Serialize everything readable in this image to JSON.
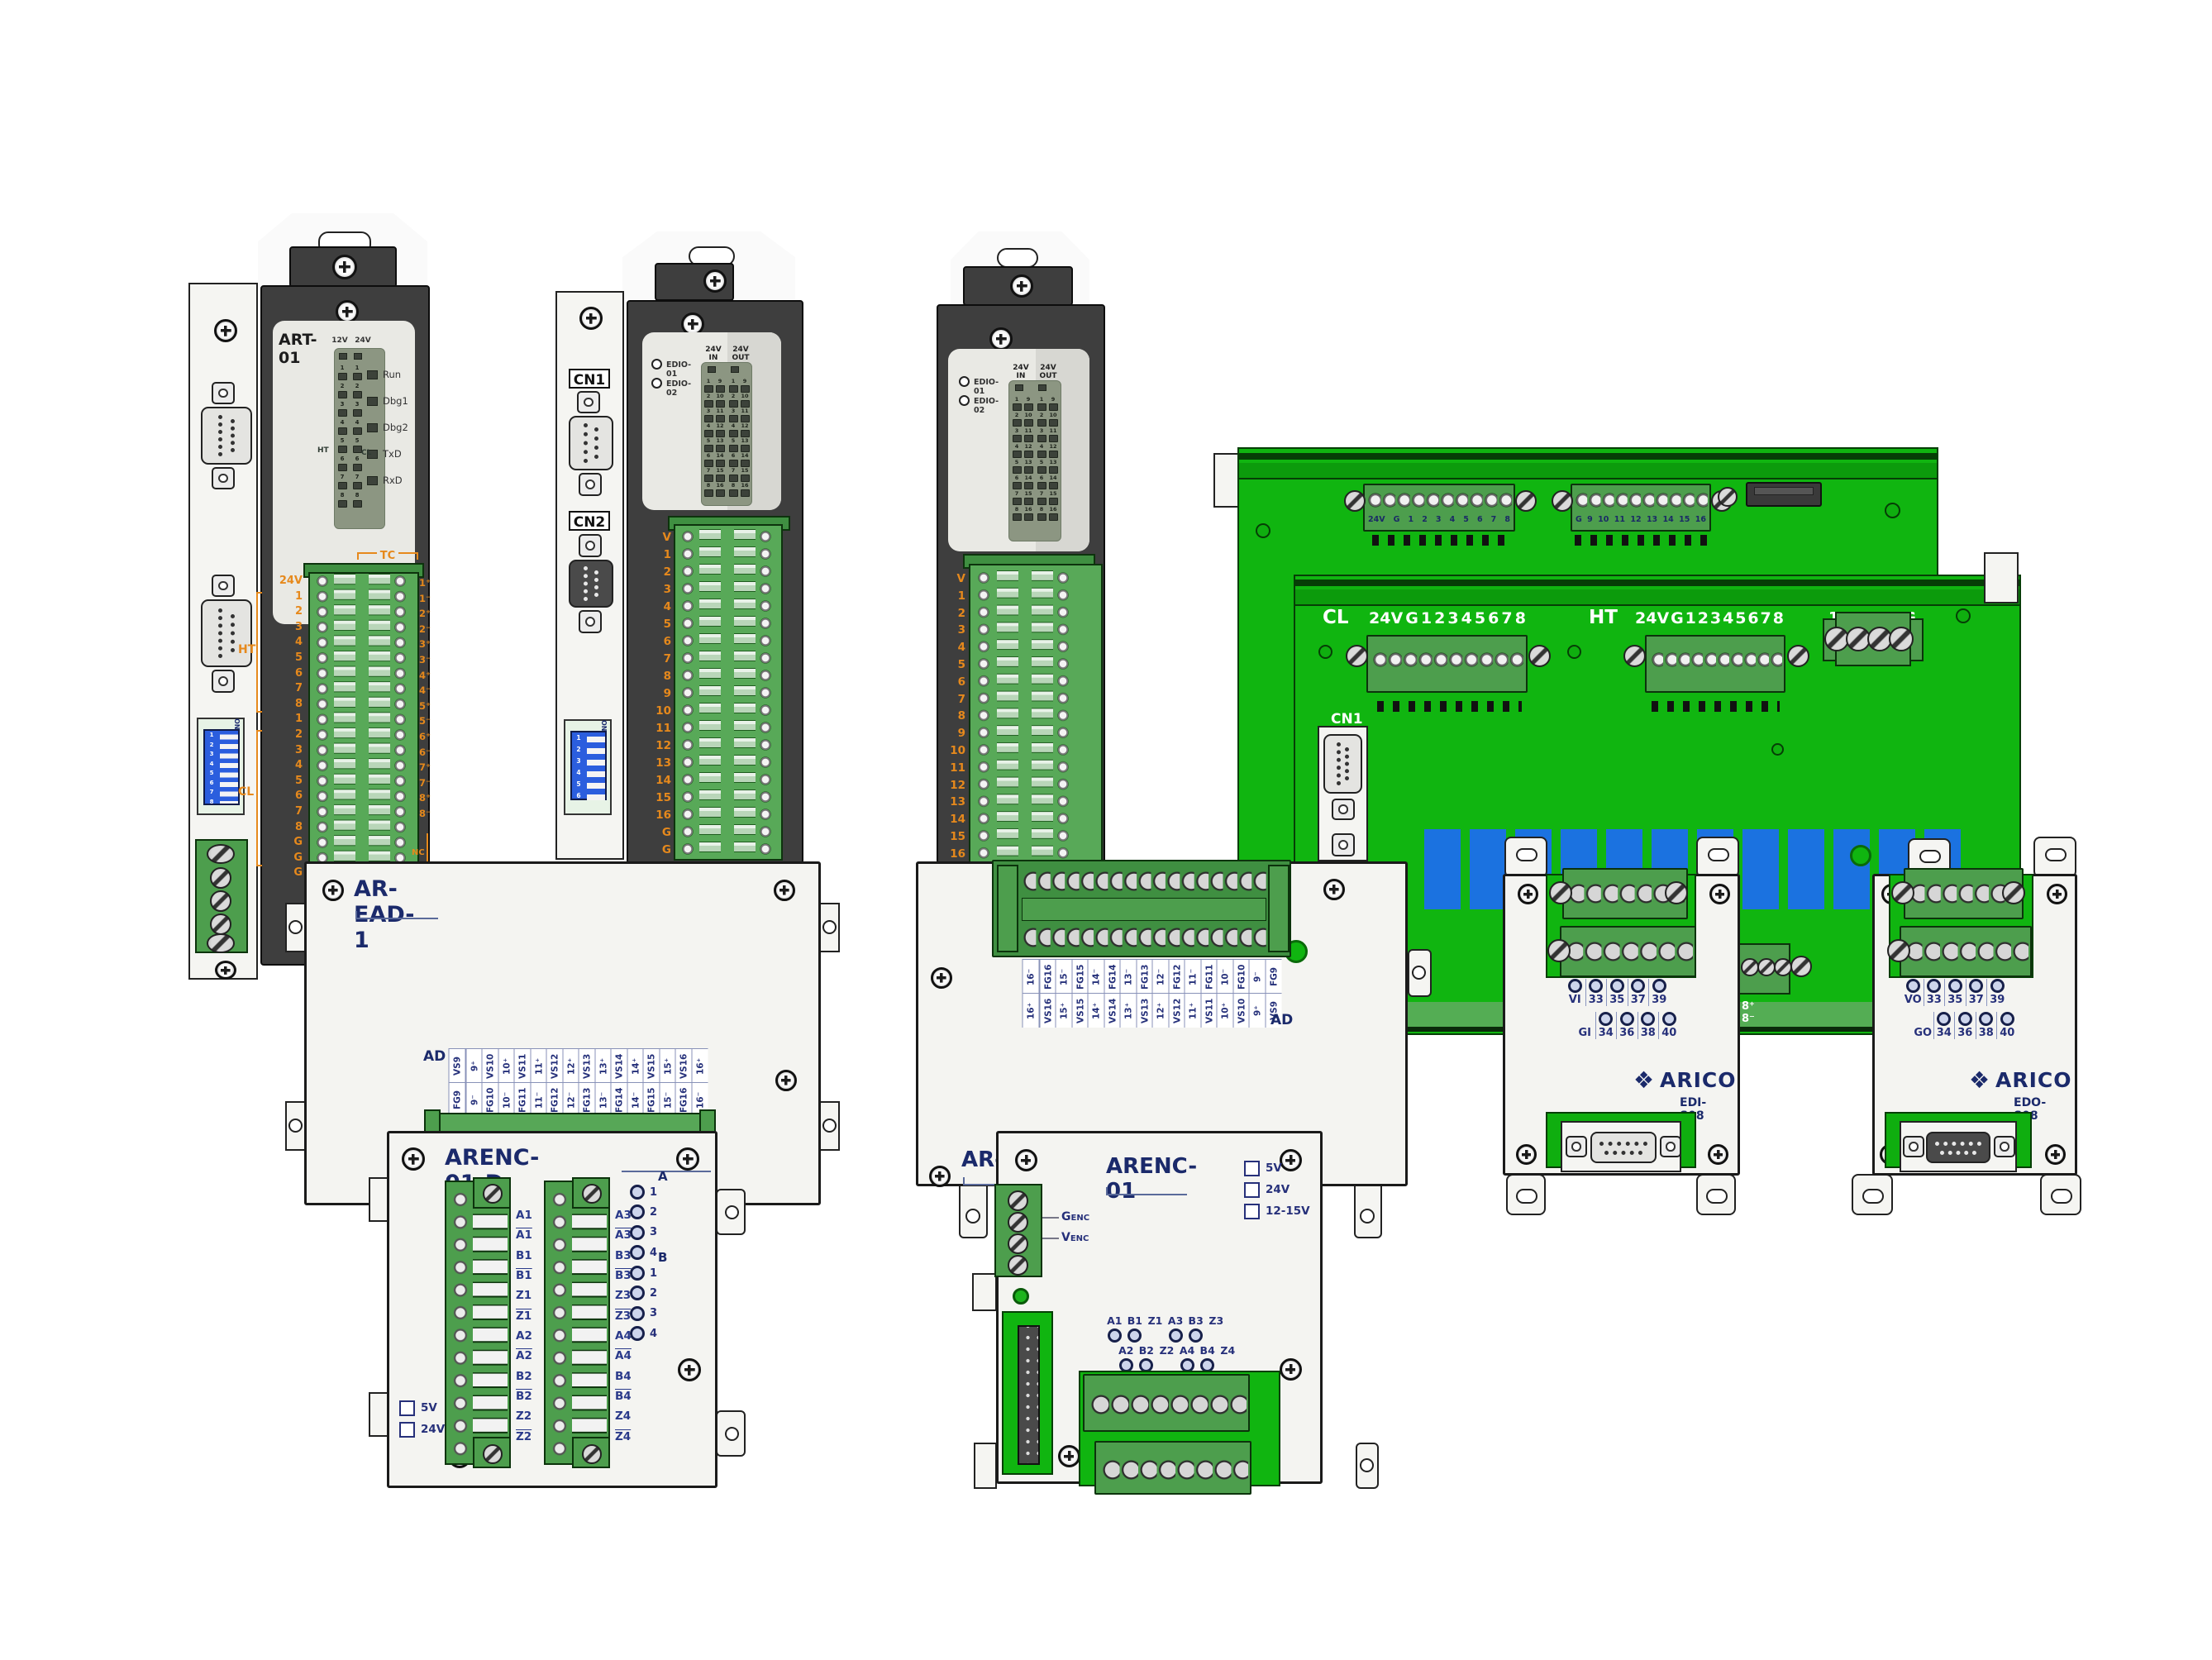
{
  "art01": {
    "title": "ART-01",
    "v12": "12V",
    "v24": "24V",
    "status": [
      "Run",
      "Dbg1",
      "Dbg2",
      "TxD",
      "RxD"
    ],
    "mnums": [
      "1",
      "2",
      "3",
      "4",
      "5",
      "6",
      "7",
      "8"
    ],
    "ht": "HT",
    "cl": "CL",
    "tc": "TC",
    "strip_left": [
      "24V",
      "1",
      "2",
      "3",
      "4",
      "5",
      "6",
      "7",
      "8",
      "1",
      "2",
      "3",
      "4",
      "5",
      "6",
      "7",
      "8",
      "G",
      "G",
      "G"
    ],
    "right": [
      "1⁺",
      "1⁻",
      "2⁺",
      "2⁻",
      "3⁺",
      "3⁻",
      "4⁺",
      "4⁻",
      "5⁺",
      "5⁻",
      "6⁺",
      "6⁻",
      "7⁺",
      "7⁻",
      "8⁺",
      "8⁻"
    ],
    "nc": "NC",
    "dip_on": "ON",
    "dip": [
      "1",
      "2",
      "3",
      "4",
      "5",
      "6",
      "7",
      "8"
    ]
  },
  "edio": {
    "cn1": "CN1",
    "cn2": "CN2",
    "led1": "EDIO-01",
    "led2": "EDIO-02",
    "v24": "24V",
    "in": "IN",
    "out": "OUT",
    "ga": [
      "1",
      "2",
      "3",
      "4",
      "5",
      "6",
      "7",
      "8"
    ],
    "gb": [
      "9",
      "10",
      "11",
      "12",
      "13",
      "14",
      "15",
      "16"
    ],
    "strip2": [
      "V",
      "1",
      "2",
      "3",
      "4",
      "5",
      "6",
      "7",
      "8",
      "9",
      "10",
      "11",
      "12",
      "13",
      "14",
      "15",
      "16",
      "G",
      "G"
    ],
    "strip3": [
      "V",
      "1",
      "2",
      "3",
      "4",
      "5",
      "6",
      "7",
      "8",
      "9",
      "10",
      "11",
      "12",
      "13",
      "14",
      "15",
      "16"
    ],
    "dip_on": "ON",
    "dip": [
      "1",
      "2",
      "3",
      "4",
      "5",
      "6"
    ]
  },
  "board": {
    "tb1": [
      "24V",
      "G",
      "1",
      "2",
      "3",
      "4",
      "5",
      "6",
      "7",
      "8"
    ],
    "tb2": [
      "G",
      "9",
      "10",
      "11",
      "12",
      "13",
      "14",
      "15",
      "16"
    ],
    "cl": "CL",
    "ht": "HT",
    "io": [
      "24V",
      "G",
      "1",
      "2",
      "3",
      "4",
      "5",
      "6",
      "7",
      "8"
    ],
    "pwr": [
      "12V",
      "12G",
      "FG"
    ],
    "cn1": "CN1",
    "edge": "8⁺ 8⁻"
  },
  "aread1": {
    "title": "AR-EAD-1",
    "ad": "AD",
    "top": [
      "VS9",
      "9⁺",
      "VS10",
      "10⁺",
      "VS11",
      "11⁺",
      "VS12",
      "12⁺",
      "VS13",
      "13⁺",
      "VS14",
      "14⁺",
      "VS15",
      "15⁺",
      "VS16",
      "16⁺"
    ],
    "bot": [
      "FG9",
      "9⁻",
      "FG10",
      "10⁻",
      "FG11",
      "11⁻",
      "FG12",
      "12⁻",
      "FG13",
      "13⁻",
      "FG14",
      "14⁻",
      "FG15",
      "15⁻",
      "FG16",
      "16⁻"
    ]
  },
  "armid": {
    "title": "AR-",
    "ad": "AD",
    "top": [
      "16⁻",
      "FG16",
      "15⁻",
      "FG15",
      "14⁻",
      "FG14",
      "13⁻",
      "FG13",
      "12⁻",
      "FG12",
      "11⁻",
      "FG11",
      "10⁻",
      "FG10",
      "9⁻",
      "FG9"
    ],
    "bot": [
      "16⁺",
      "VS16",
      "15⁺",
      "VS15",
      "14⁺",
      "VS14",
      "13⁺",
      "VS13",
      "12⁺",
      "VS12",
      "11⁺",
      "VS11",
      "10⁺",
      "VS10",
      "9⁺",
      "VS9"
    ]
  },
  "arenc01d": {
    "title": "ARENC-01-D",
    "t1": [
      {
        "t": "A1"
      },
      {
        "t": "A1",
        "bar": true
      },
      {
        "t": "B1"
      },
      {
        "t": "B1",
        "bar": true
      },
      {
        "t": "Z1"
      },
      {
        "t": "Z1",
        "bar": true
      },
      {
        "t": "A2"
      },
      {
        "t": "A2",
        "bar": true
      },
      {
        "t": "B2"
      },
      {
        "t": "B2",
        "bar": true
      },
      {
        "t": "Z2"
      },
      {
        "t": "Z2",
        "bar": true
      }
    ],
    "t2": [
      {
        "t": "A3"
      },
      {
        "t": "A3",
        "bar": true
      },
      {
        "t": "B3"
      },
      {
        "t": "B3",
        "bar": true
      },
      {
        "t": "Z3"
      },
      {
        "t": "Z3",
        "bar": true
      },
      {
        "t": "A4"
      },
      {
        "t": "A4",
        "bar": true
      },
      {
        "t": "B4"
      },
      {
        "t": "B4",
        "bar": true
      },
      {
        "t": "Z4"
      },
      {
        "t": "Z4",
        "bar": true
      }
    ],
    "ga": "A",
    "gb": "B",
    "lednums": [
      "1",
      "2",
      "3",
      "4"
    ],
    "checks": [
      "5V",
      "24V"
    ]
  },
  "arenc01": {
    "title": "ARENC-01",
    "checks": [
      "5V",
      "24V",
      "12-15V"
    ],
    "genc": "GENC",
    "venc": "VENC",
    "sig1": [
      {
        "t": "A1",
        "pin": true
      },
      {
        "t": "B1",
        "pin": true
      },
      {
        "t": "Z1"
      },
      {
        "t": "A3",
        "pin": true
      },
      {
        "t": "B3",
        "pin": true
      },
      {
        "t": "Z3"
      }
    ],
    "sig2": [
      {
        "t": "A2",
        "pin": true
      },
      {
        "t": "B2",
        "pin": true
      },
      {
        "t": "Z2"
      },
      {
        "t": "A4",
        "pin": true
      },
      {
        "t": "B4",
        "pin": true
      },
      {
        "t": "Z4"
      }
    ]
  },
  "edi": {
    "brand": "ARICO",
    "model": "EDI-S08",
    "r1": [
      {
        "t": "VI",
        "pin": true
      },
      {
        "t": "33",
        "pin": true
      },
      {
        "t": "35",
        "pin": true
      },
      {
        "t": "37",
        "pin": true
      },
      {
        "t": "39",
        "pin": true
      }
    ],
    "r2": [
      {
        "t": "GI"
      },
      {
        "t": "34",
        "pin": true
      },
      {
        "t": "36",
        "pin": true
      },
      {
        "t": "38",
        "pin": true
      },
      {
        "t": "40",
        "pin": true
      }
    ]
  },
  "edo": {
    "brand": "ARICO",
    "model": "EDO-S08",
    "r1": [
      {
        "t": "VO",
        "pin": true
      },
      {
        "t": "33",
        "pin": true
      },
      {
        "t": "35",
        "pin": true
      },
      {
        "t": "37",
        "pin": true
      },
      {
        "t": "39",
        "pin": true
      }
    ],
    "r2": [
      {
        "t": "GO"
      },
      {
        "t": "34",
        "pin": true
      },
      {
        "t": "36",
        "pin": true
      },
      {
        "t": "38",
        "pin": true
      },
      {
        "t": "40",
        "pin": true
      }
    ]
  }
}
